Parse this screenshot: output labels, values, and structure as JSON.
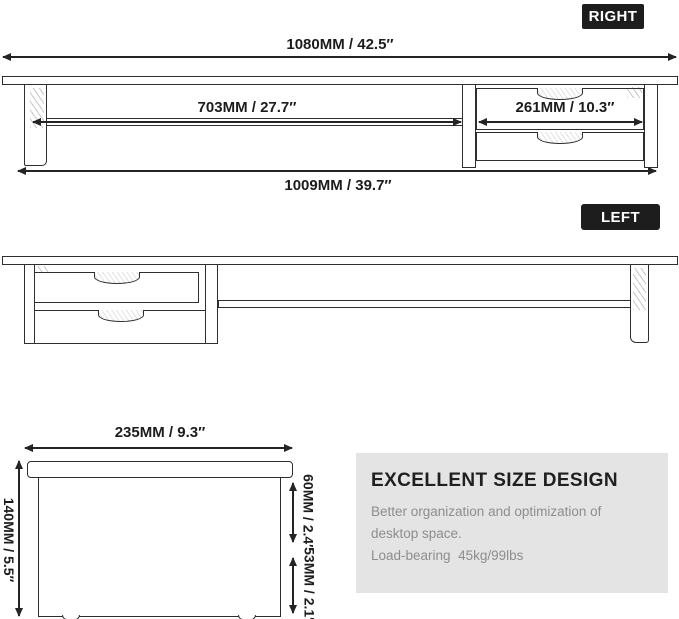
{
  "right_view": {
    "badge": "RIGHT",
    "dim_total_width": "1080MM / 42.5″",
    "dim_shelf_width": "703MM / 27.7″",
    "dim_drawer_width": "261MM / 10.3″",
    "dim_base_width": "1009MM / 39.7″"
  },
  "left_view": {
    "badge": "LEFT"
  },
  "side_view": {
    "dim_depth": "235MM / 9.3″",
    "dim_total_height": "140MM / 5.5″",
    "dim_top_clearance": "60MM / 2.4″",
    "dim_drawer_height": "53MM / 2.1″"
  },
  "info_panel": {
    "title": "EXCELLENT SIZE DESIGN",
    "body_line1": "Better organization and optimization of",
    "body_line2": "desktop space.",
    "body_line3": "Load-bearing  45kg/99lbs"
  },
  "colors": {
    "line": "#2e2e2e",
    "badge_bg": "#1d1d1d",
    "badge_text": "#ffffff",
    "panel_bg": "#e4e4e4",
    "panel_title": "#1f1f1f",
    "panel_text": "#8d8d8d"
  }
}
